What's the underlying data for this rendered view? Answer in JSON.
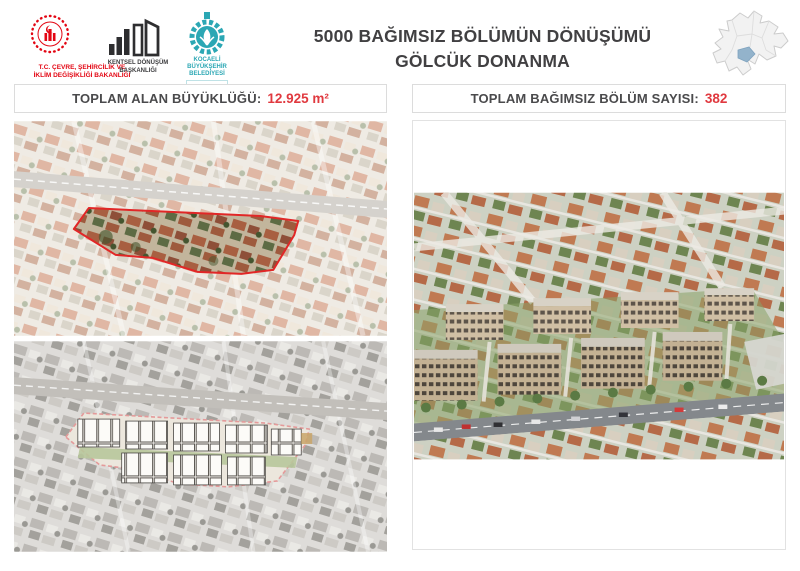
{
  "header": {
    "title_line1": "5000 BAĞIMSIZ BÖLÜMÜN DÖNÜŞÜMÜ",
    "title_line2": "GÖLCÜK DONANMA"
  },
  "logos": {
    "ministry": {
      "line1": "T.C. ÇEVRE, ŞEHİRCİLİK VE",
      "line2": "İKLİM DEĞİŞİKLİĞİ BAKANLIĞI"
    },
    "kentsel": {
      "line1": "KENTSEL DÖNÜŞÜM",
      "line2": "BAŞKANLIĞI"
    },
    "kocaeli": {
      "line1": "KOCAELİ",
      "line2": "BÜYÜKŞEHİR",
      "line3": "BELEDİYESİ"
    }
  },
  "stats": {
    "left": {
      "label": "TOPLAM ALAN BÜYÜKLÜĞÜ:",
      "value": "12.925 m²"
    },
    "right": {
      "label": "TOPLAM BAĞIMSIZ BÖLÜM SAYISI:",
      "value": "382"
    }
  },
  "colors": {
    "accent_red": "#e0393f",
    "ministry_red": "#e30613",
    "kocaeli_teal": "#2ba7b4",
    "title_gray": "#414042",
    "map_highlight": "#93b3cb",
    "site_outline_red": "#e12727"
  }
}
